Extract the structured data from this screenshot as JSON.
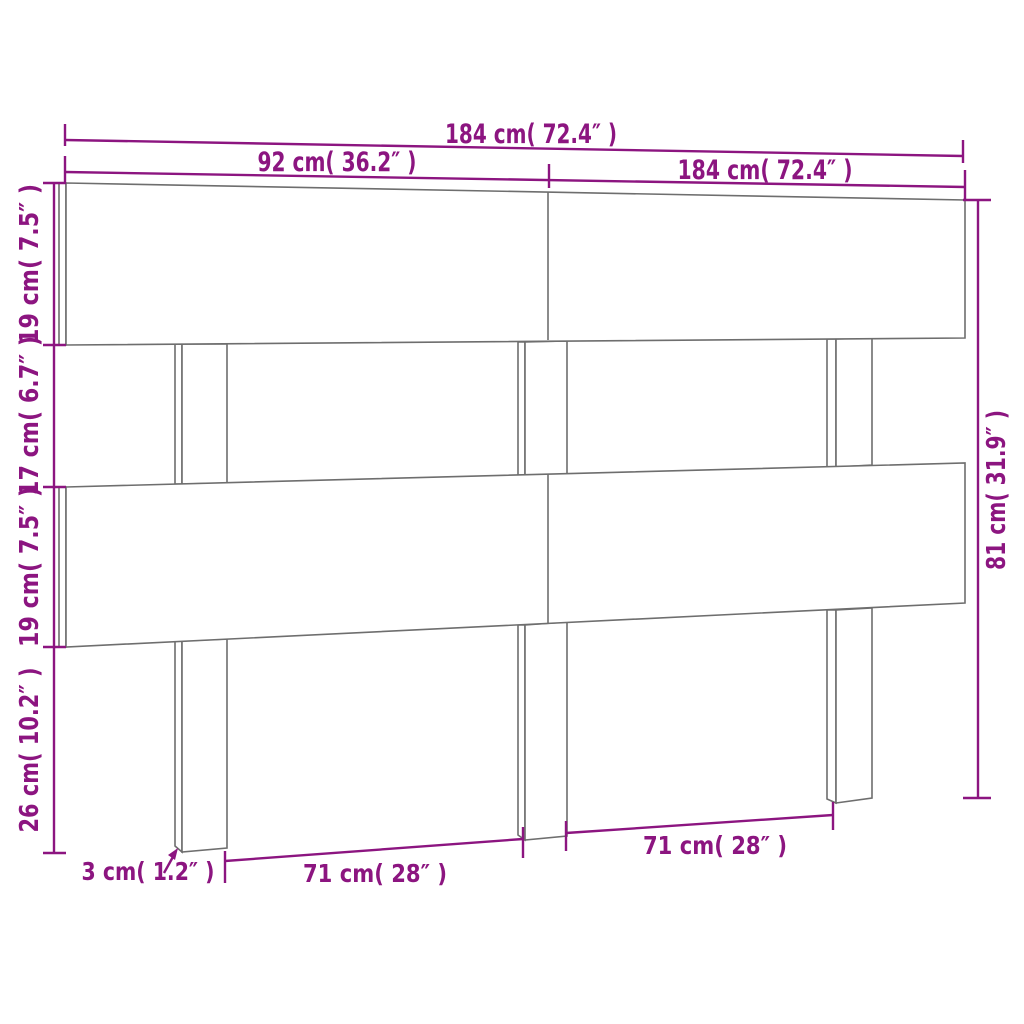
{
  "diagram": {
    "subject": "headboard-dimension-diagram",
    "colors": {
      "dimension_color": "#8c1580",
      "outline_color": "#6e6e6e",
      "background": "#ffffff"
    },
    "labels": {
      "total_width": "184 cm( 72.4″ )",
      "half_width": "92 cm( 36.2″ )",
      "total_width_right": "184 cm( 72.4″ )",
      "top_board_height": "19 cm( 7.5″ )",
      "gap_height": "17 cm( 6.7″ )",
      "middle_board_height": "19 cm( 7.5″ )",
      "leg_section_height": "26 cm( 10.2″ )",
      "total_height": "81 cm( 31.9″ )",
      "board_thickness": "3 cm( 1.2″ )",
      "leg_span_left": "71 cm( 28″ )",
      "leg_span_right": "71 cm( 28″ )"
    }
  }
}
